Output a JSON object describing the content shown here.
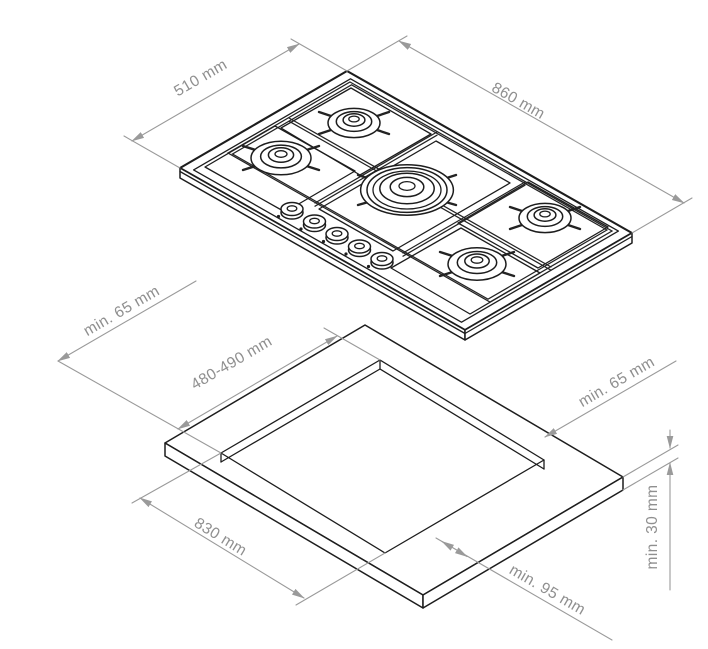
{
  "page": {
    "background": "#ffffff"
  },
  "diagram": {
    "kind": "hob-installation-drawing",
    "hob": {
      "description": "5-burner gas hob, isometric view",
      "burner_count": 5,
      "knob_count": 5,
      "depth_label": "510 mm",
      "width_label": "860 mm"
    },
    "cutout": {
      "description": "worktop cutout, isometric view",
      "clearance_left_label": "min. 65 mm",
      "cutout_depth_label": "480-490 mm",
      "clearance_right_label": "min. 65 mm",
      "cutout_width_label": "830 mm",
      "clearance_front_label": "min. 95 mm",
      "worktop_thickness_label": "min. 30 mm"
    },
    "colors": {
      "outline": "#1d1d1d",
      "dimension_line": "#9a9a9a",
      "label_text": "#8f8f8f",
      "background": "#ffffff"
    }
  }
}
